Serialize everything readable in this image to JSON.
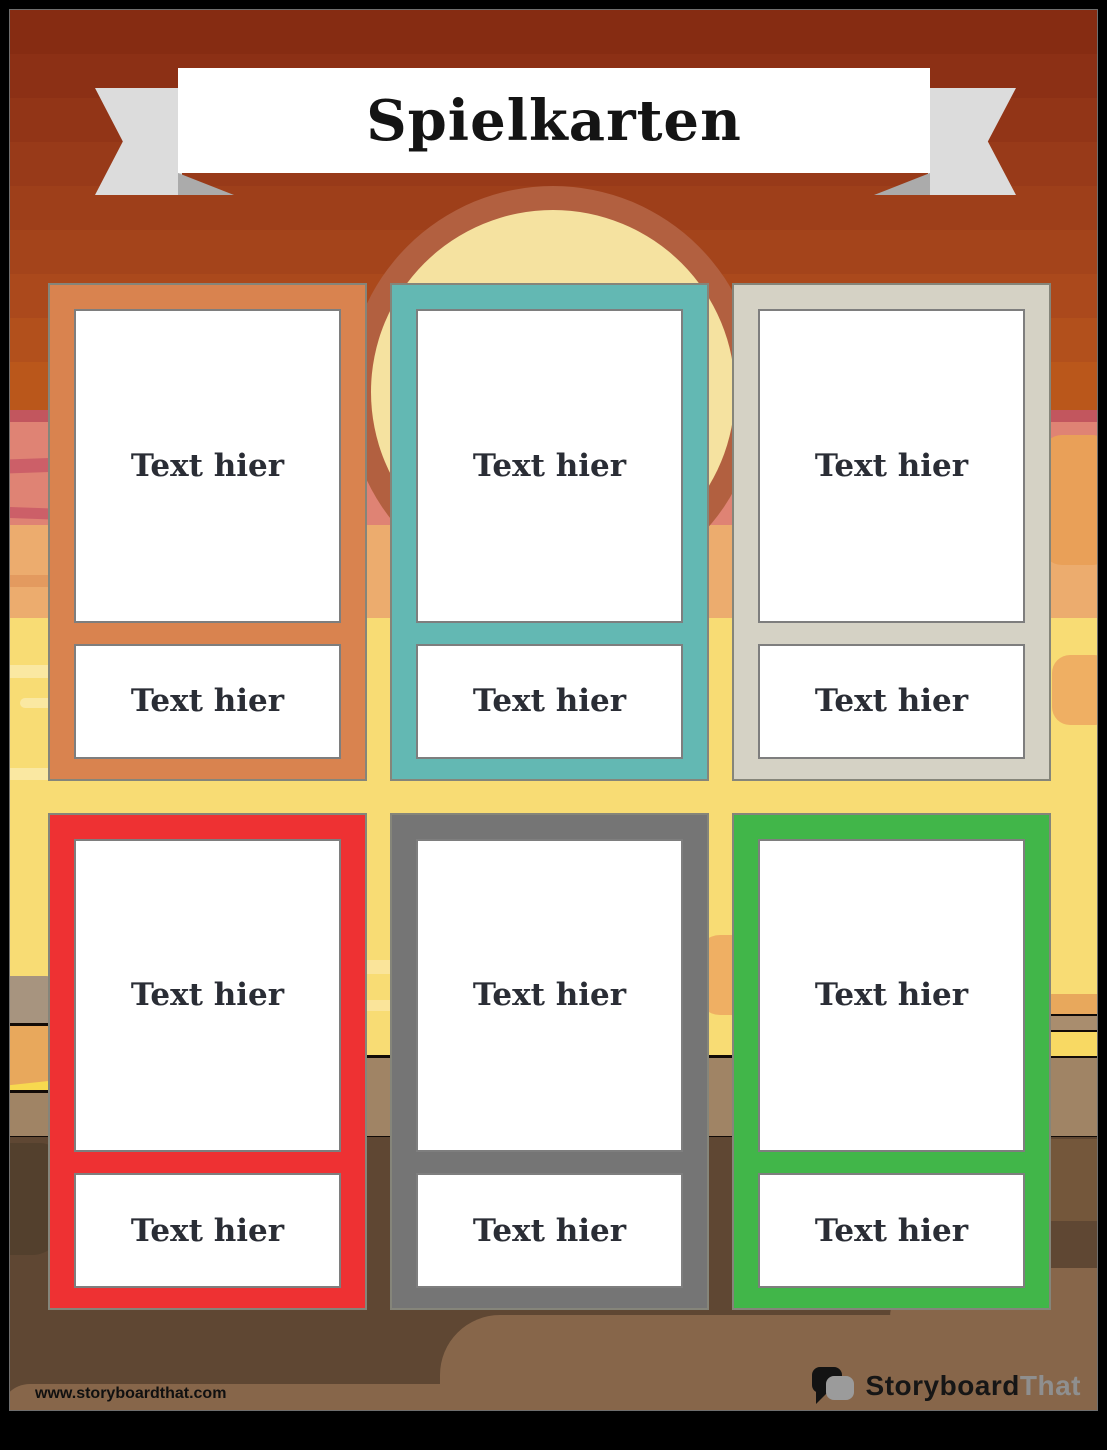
{
  "page": {
    "banner": {
      "title": "Spielkarten"
    },
    "cards": [
      {
        "color": "#D9834F",
        "top_text": "Text hier",
        "bottom_text": "Text hier"
      },
      {
        "color": "#63B8B3",
        "top_text": "Text hier",
        "bottom_text": "Text hier"
      },
      {
        "color": "#D5D2C5",
        "top_text": "Text hier",
        "bottom_text": "Text hier"
      },
      {
        "color": "#EE3133",
        "top_text": "Text hier",
        "bottom_text": "Text hier"
      },
      {
        "color": "#757575",
        "top_text": "Text hier",
        "bottom_text": "Text hier"
      },
      {
        "color": "#41B649",
        "top_text": "Text hier",
        "bottom_text": "Text hier"
      }
    ],
    "footer": {
      "url": "www.storyboardthat.com",
      "logo": {
        "storyboard": "Storyboard",
        "that": "That"
      }
    },
    "theme": {
      "card_text_color": "#2A2D35",
      "sky_top": "#862C12",
      "sunset_pink": "#DF8374",
      "sunset_peach": "#ECAC6E",
      "desert_yellow": "#F8DC74",
      "sun": "#F5E2A0",
      "sun_ring": "#B26040",
      "horizon_tan": "#A08465",
      "ground_brown": "#5F4733",
      "ground_light": "#87664A"
    }
  }
}
